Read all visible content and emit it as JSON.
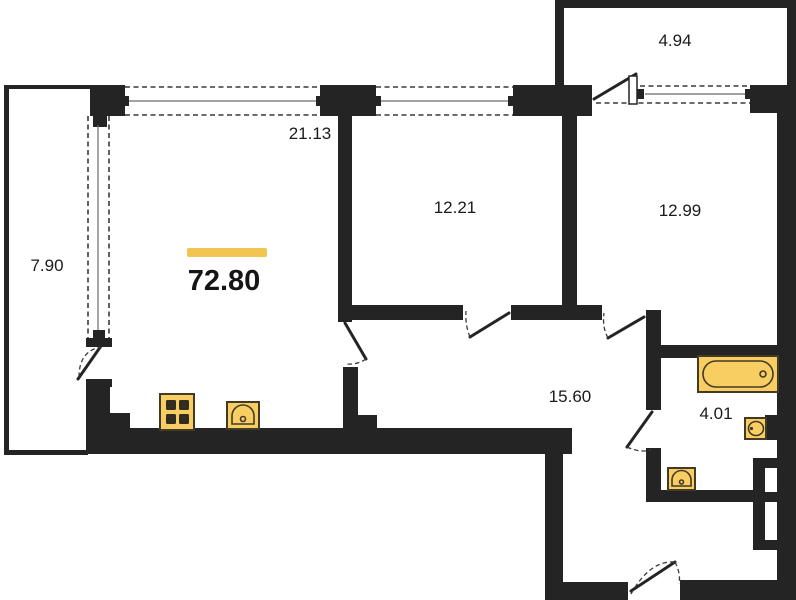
{
  "plan": {
    "title": "apartment-floor-plan",
    "total_area": "72.80",
    "rooms": [
      {
        "id": "balcony",
        "area": "7.90"
      },
      {
        "id": "living-room",
        "area": "21.13"
      },
      {
        "id": "bedroom-1",
        "area": "12.21"
      },
      {
        "id": "bedroom-2",
        "area": "12.99"
      },
      {
        "id": "loggia",
        "area": "4.94"
      },
      {
        "id": "hallway",
        "area": "15.60"
      },
      {
        "id": "bathroom",
        "area": "4.01"
      }
    ],
    "fixtures": [
      "stove-icon",
      "kitchen-sink-icon",
      "bathtub-icon",
      "washbasin-icon",
      "sink-icon"
    ],
    "colors": {
      "wall": "#242424",
      "fixture_fill": "#F8CE63",
      "fixture_stroke": "#423A27",
      "accent_bar": "#F2C551",
      "background": "#FFFFFF",
      "text": "#1B1B1B"
    }
  }
}
